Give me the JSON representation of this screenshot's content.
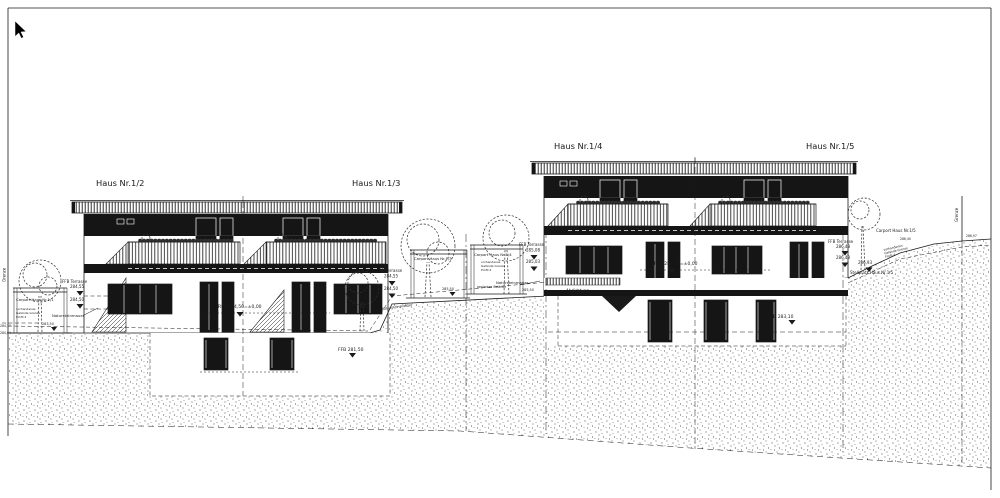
{
  "drawing": {
    "background": "#ffffff",
    "ink": "#1a1a1a",
    "houses": {
      "h12": "Haus Nr.1/2",
      "h13": "Haus Nr.1/3",
      "h14": "Haus Nr.1/4",
      "h15": "Haus Nr.1/5"
    },
    "boundary": {
      "left": "Grenze",
      "right": "Grenze"
    },
    "carports": {
      "c11": "Carport Haus Nr.1/1",
      "c13": "Carport Haus Nr.1/3",
      "c14": "Carport Haus Nr.1/4",
      "c15": "Carport Haus Nr.1/5"
    },
    "notes": {
      "existing_grade": [
        "vorhandenes",
        "Gelände Grenze",
        "Profil 4"
      ],
      "planned_grade": "geplantes Gelände",
      "stone_wall": "Natursteinmauer",
      "stone_paving": "Natursteinpflaster",
      "waterproofing": "Abdichtung",
      "parking_15": "Stellplatz Haus Nr.1/5"
    },
    "levels": {
      "terrace_label": "FFB Terrasse",
      "left_terrace_ffb": "284,55",
      "left_terrace_grade": "284,50",
      "left_wall_top": "283,50",
      "left_edge_upper": "284,77",
      "left_edge_lower": "284,04",
      "left_rfb": "RFB 284,50=±0,00",
      "left_basement_ffb": "FFB 281,50",
      "mid_terrace_ffb": "284,55",
      "mid_terrace_grade": "284,50",
      "mid_carport_grade": "285,50",
      "mid2_terrace_ffb": "285,08",
      "mid2_terrace_grade": "285,03",
      "mid2_wall_grade": "285,50",
      "right_rfb": "RFB 286,10=±0,00",
      "right_basement_ffb": "FFB 283,10",
      "right_terrace_ffb": "286,48",
      "right_terrace_grade": "286,43",
      "right_drive_grade": "286,93",
      "right_slope_a": "286,40",
      "right_slope_b": "286,97"
    }
  }
}
